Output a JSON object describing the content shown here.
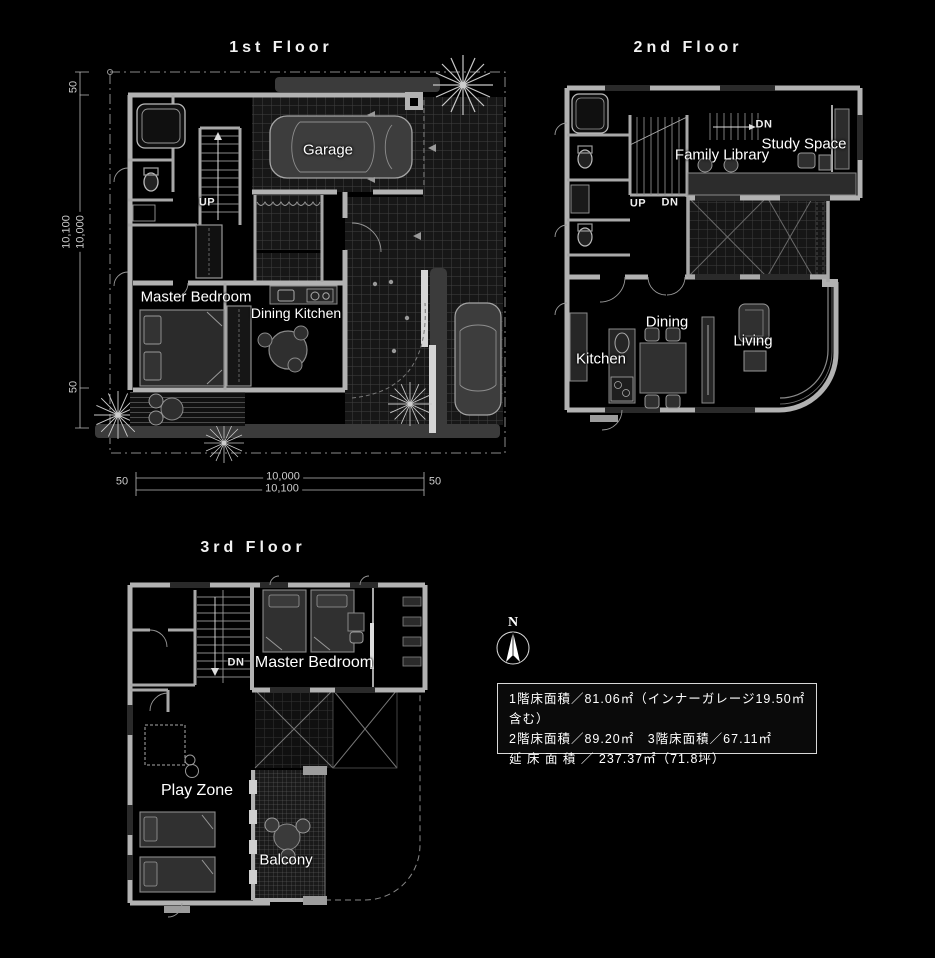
{
  "document": {
    "type": "house-floor-plan-sheet",
    "background": "#000000"
  },
  "floors": {
    "first": {
      "title": "1st Floor",
      "rooms": {
        "garage": "Garage",
        "master_bedroom": "Master Bedroom",
        "dining_kitchen": "Dining Kitchen"
      },
      "stairs": {
        "up": "UP"
      },
      "dimensions": {
        "side_top": "50",
        "side_total": "10,100",
        "side_inner": "10,000",
        "side_bottom": "50",
        "bottom_left": "50",
        "bottom_inner": "10,000",
        "bottom_total": "10,100",
        "bottom_right": "50"
      }
    },
    "second": {
      "title": "2nd Floor",
      "rooms": {
        "family_library": "Family Library",
        "study_space": "Study Space",
        "kitchen": "Kitchen",
        "dining": "Dining",
        "living": "Living"
      },
      "stairs": {
        "dn_upper": "DN",
        "up": "UP",
        "dn_lower": "DN"
      }
    },
    "third": {
      "title": "3rd Floor",
      "rooms": {
        "master_bedroom": "Master Bedroom",
        "play_zone": "Play Zone",
        "balcony": "Balcony"
      },
      "stairs": {
        "dn": "DN"
      }
    }
  },
  "compass": {
    "north_label": "N"
  },
  "area_table": {
    "line1": "1階床面積／81.06㎡（インナーガレージ19.50㎡含む）",
    "line2": "2階床面積／89.20㎡　3階床面積／67.11㎡",
    "line3": "延 床 面 積 ／ 237.37㎡（71.8坪）"
  },
  "colors": {
    "background": "#000000",
    "wall": "#b2b2b2",
    "wall_light": "#d5d5d5",
    "grid_line": "#3f3f3f",
    "furniture": "#333333",
    "hedge": "#3b3b3b",
    "label_text": "#ffffff",
    "dimension_text": "#cccccc"
  }
}
